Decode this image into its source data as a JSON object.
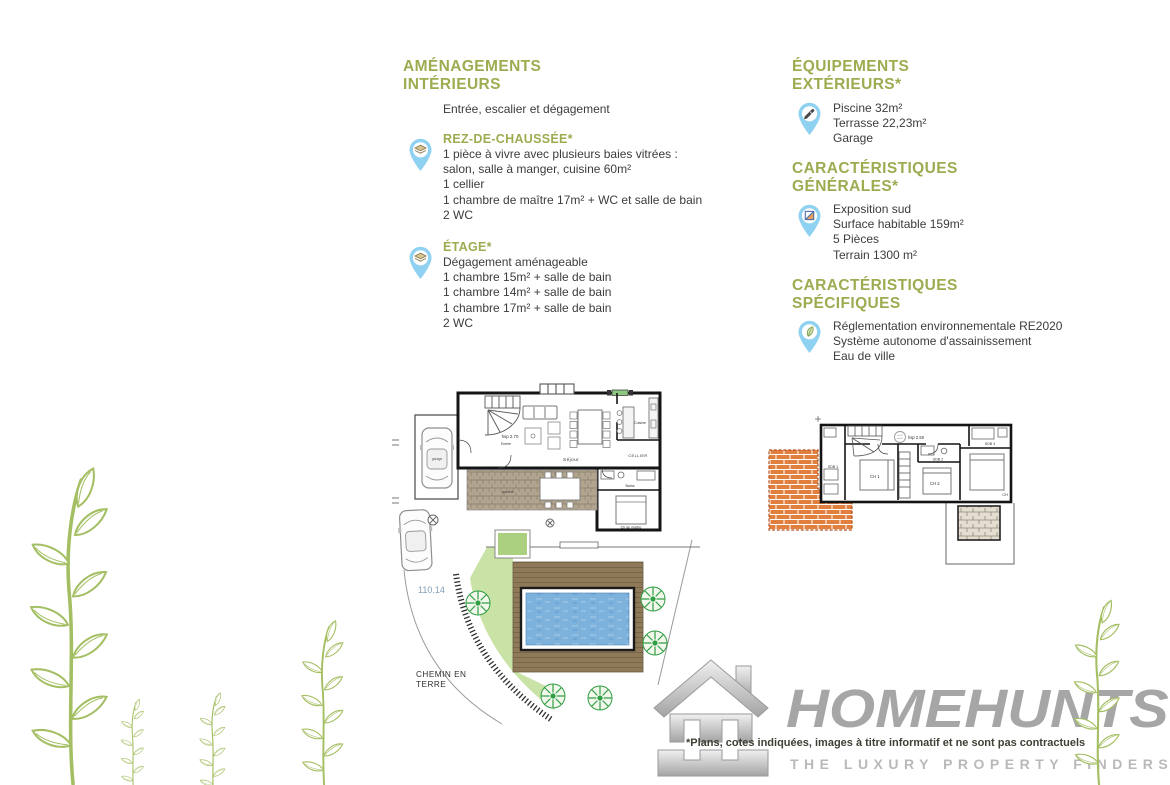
{
  "colors": {
    "heading_green": "#9cac50",
    "text_dark": "#3c3c3c",
    "pin_blue": "#8ed1f0",
    "pool_blue": "#7cb2dc",
    "deck_brown": "#8e7a59",
    "lawn_green": "#c9e2a5",
    "roof_orange": "#e07f3e",
    "logo_gray": "#a6a6a6",
    "plant_green": "#a4bf63"
  },
  "left": {
    "title1": "AMÉNAGEMENTS",
    "title2": "INTÉRIEURS",
    "intro": "Entrée, escalier et dégagement",
    "rdc": {
      "heading": "REZ-DE-CHAUSSÉE*",
      "lines": [
        "1 pièce à vivre avec plusieurs baies vitrées :",
        "salon, salle à manger, cuisine 60m²",
        "1 cellier",
        "1 chambre de maître 17m² + WC et salle de bain",
        "2 WC"
      ]
    },
    "etage": {
      "heading": "ÉTAGE*",
      "lines": [
        "Dégagement aménageable",
        "1 chambre 15m² + salle de bain",
        "1 chambre 14m² + salle de bain",
        "1 chambre 17m² + salle de bain",
        "2 WC"
      ]
    }
  },
  "right": {
    "equip": {
      "title1": "ÉQUIPEMENTS",
      "title2": "EXTÉRIEURS*",
      "lines": [
        "Piscine 32m²",
        "Terrasse 22,23m²",
        "Garage"
      ]
    },
    "general": {
      "title1": "CARACTÉRISTIQUES",
      "title2": "GÉNÉRALES*",
      "lines": [
        "Exposition sud",
        "Surface habitable 159m²",
        "5 Pièces",
        "Terrain 1300 m²"
      ]
    },
    "specific": {
      "title1": "CARACTÉRISTIQUES",
      "title2": "SPÉCIFIQUES",
      "lines": [
        "Réglementation environnementale RE2020",
        "Système autonome d'assainissement",
        "Eau de ville"
      ]
    }
  },
  "ground_plan": {
    "garage": "garage",
    "hsp": "hsp 2.70",
    "entree": "Entrée",
    "sejour": "Séjour",
    "cuisine": "Cuisine",
    "cellier": "CELLIER",
    "bains": "Bains",
    "master": "Ch de maître",
    "porche": "porche",
    "dim": "110.14",
    "chemin1": "CHEMIN EN",
    "chemin2": "TERRE"
  },
  "floor_plan": {
    "hsp": "hsp 2.50",
    "sdb1": "SDB 1",
    "ch1": "CH 1",
    "sdb2": "SDB 2",
    "ch2": "CH 2",
    "sdb3": "SDB 3",
    "ch3": "CH"
  },
  "footer": {
    "disclaimer": "*Plans, cotes indiquées, images à titre informatif et ne sont pas contractuels",
    "brand": "HOMEHUNTS",
    "tagline": "THE LUXURY PROPERTY FINDERS"
  }
}
